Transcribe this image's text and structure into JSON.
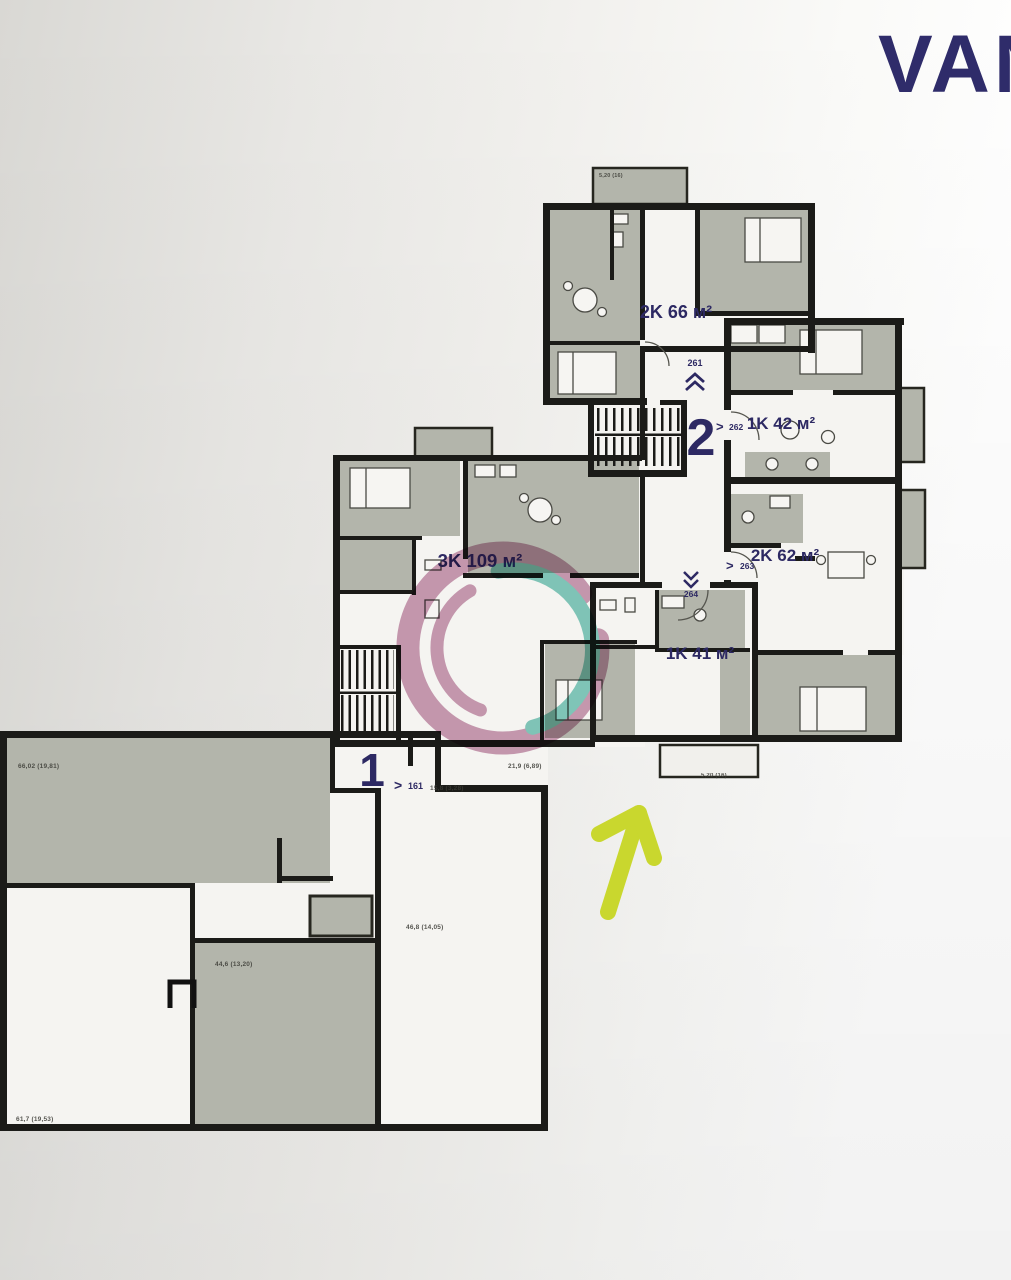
{
  "brand": {
    "logo_text": "VAN"
  },
  "floor_plan": {
    "apartments": [
      {
        "label": "2K 66 м²",
        "number": "261"
      },
      {
        "label": "1K 42 м²",
        "number": "262"
      },
      {
        "label": "2K 62 м²",
        "number": "263"
      },
      {
        "label": "1K 41 м²",
        "number": "264"
      },
      {
        "label": "3K 109 м²"
      }
    ],
    "entrances": {
      "upper": {
        "number": "2",
        "apartment": "262"
      },
      "lower": {
        "number": "1",
        "apartment": "161"
      }
    },
    "pointer": ">",
    "dimensions": {
      "commercial_top_left": "66,02 (19,81)",
      "commercial_bottom_left": "61,7 (19,53)",
      "commercial_center": "44,6 (13,20)",
      "commercial_right": "46,8 (14,05)",
      "entrance_hall": "21,9 (6,89)",
      "entry_step": "15,8 (3,28)",
      "balcony_top": "5,20 (16)",
      "balcony_bottom": "5,20 (16)"
    }
  },
  "colors": {
    "wall": "#1b1b18",
    "room_fill": "#b3b5ab",
    "paper": "#f2f1ee",
    "label_navy": "#2d2963",
    "arrow_green": "#c9d72e",
    "watermark_pink": "#a04b79",
    "watermark_teal": "#1fa18d"
  }
}
